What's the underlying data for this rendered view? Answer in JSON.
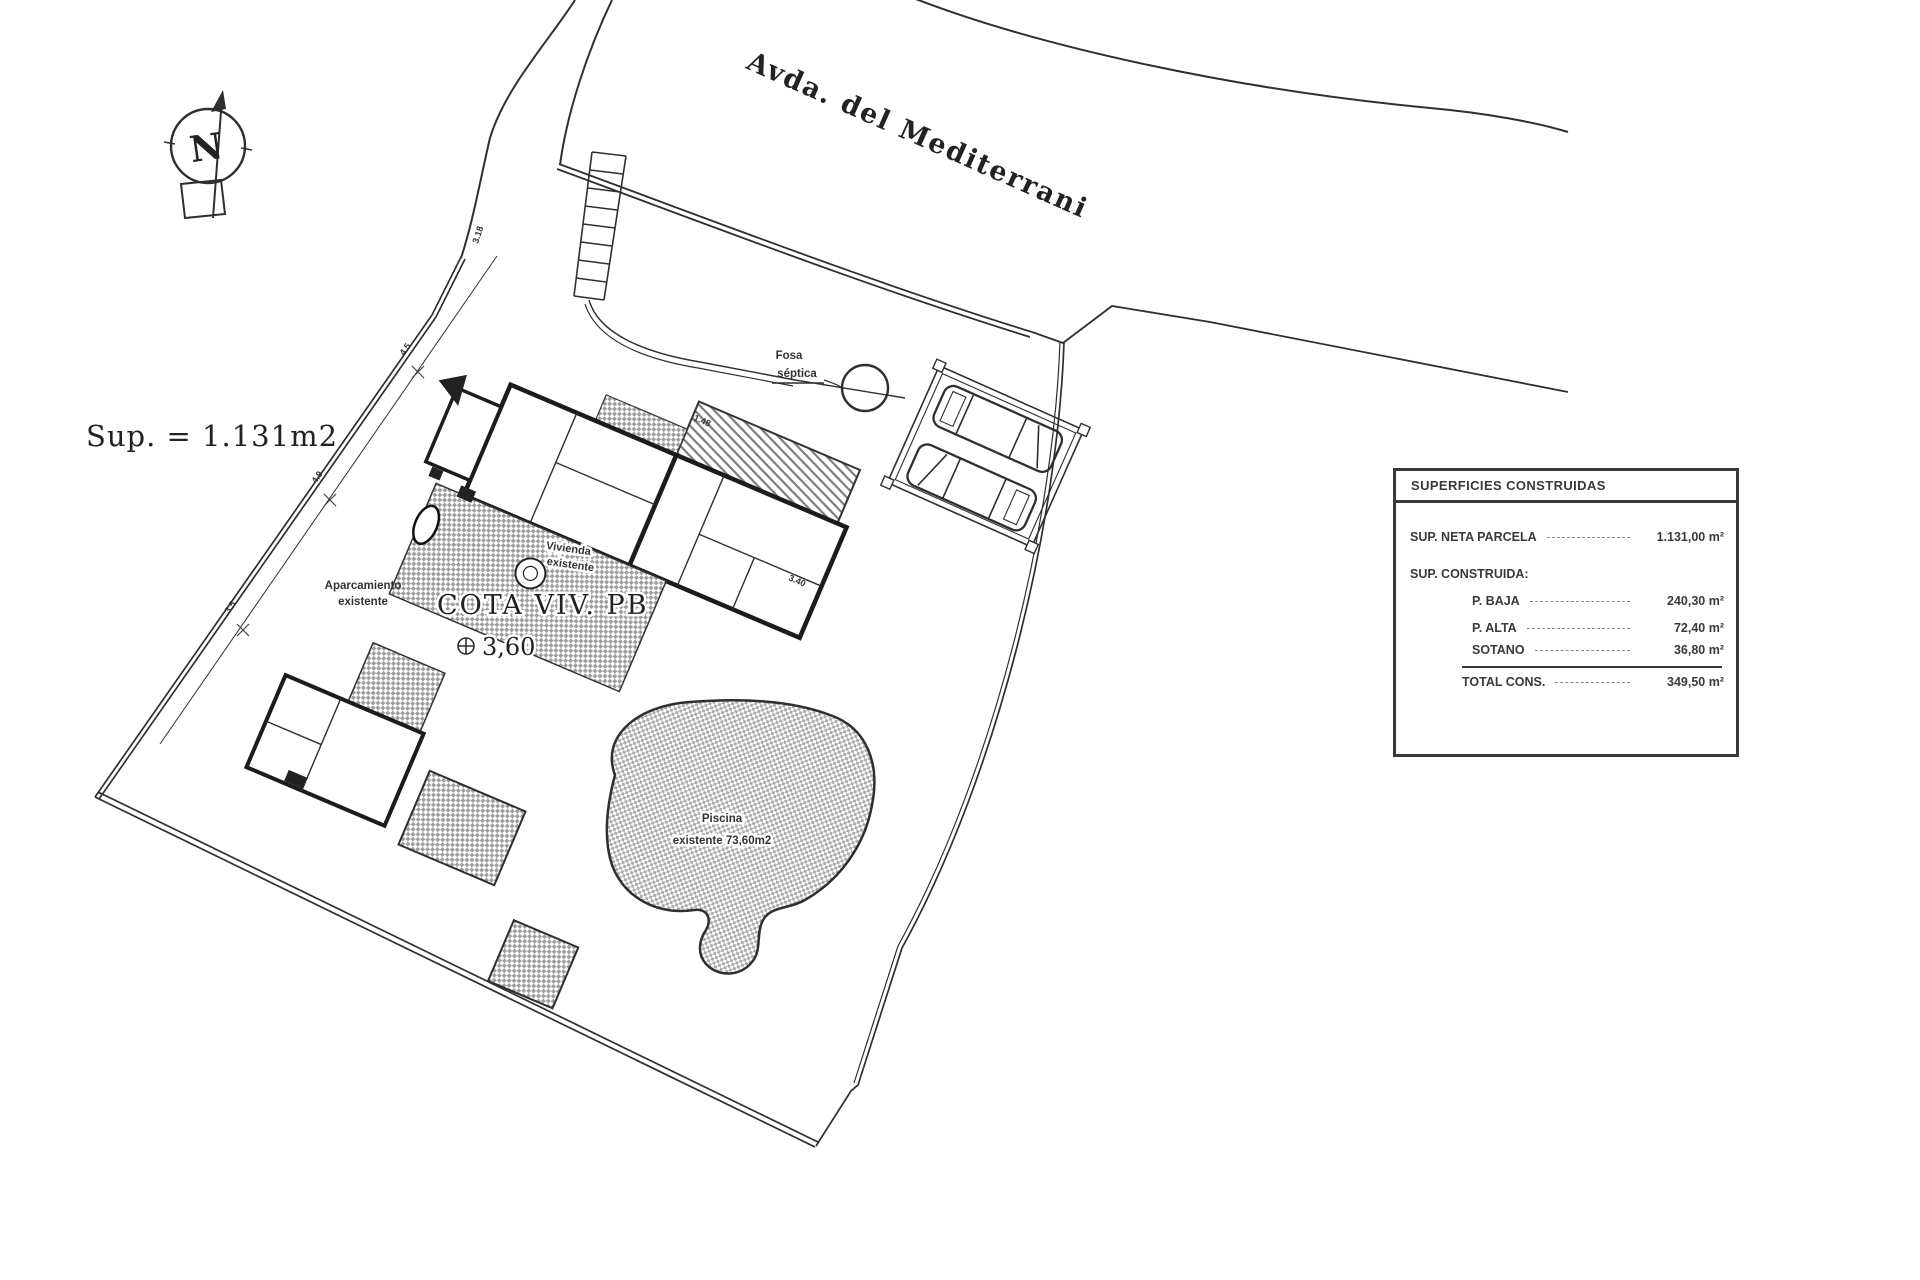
{
  "street": {
    "name": "Avda. del Mediterrani"
  },
  "site": {
    "area_label": "Sup. = 1.131m2",
    "north_letter": "N",
    "fosa_line1": "Fosa",
    "fosa_line2": "séptica",
    "vivienda_line1": "Vivienda",
    "vivienda_line2": "existente",
    "cota_label": "COTA VIV. PB",
    "cota_value": "3,60",
    "aparcamiento_line1": "Aparcamiento",
    "aparcamiento_line2": "existente",
    "piscina_line1": "Piscina",
    "piscina_line2": "existente 73,60m2",
    "dims": {
      "d1": "3.18",
      "d2": "1.48",
      "d3": "3.40",
      "d4": "4.5",
      "d5": "4.9",
      "d6": "3.5"
    }
  },
  "table": {
    "title": "SUPERFICIES CONSTRUIDAS",
    "neta": {
      "label": "SUP. NETA PARCELA",
      "value": "1.131,00 m²"
    },
    "construida_label": "SUP. CONSTRUIDA:",
    "baja": {
      "label": "P. BAJA",
      "value": "240,30 m²"
    },
    "alta": {
      "label": "P. ALTA",
      "value": "72,40 m²"
    },
    "sotano": {
      "label": "SOTANO",
      "value": "36,80 m²"
    },
    "total": {
      "label": "TOTAL CONS.",
      "value": "349,50 m²"
    }
  }
}
